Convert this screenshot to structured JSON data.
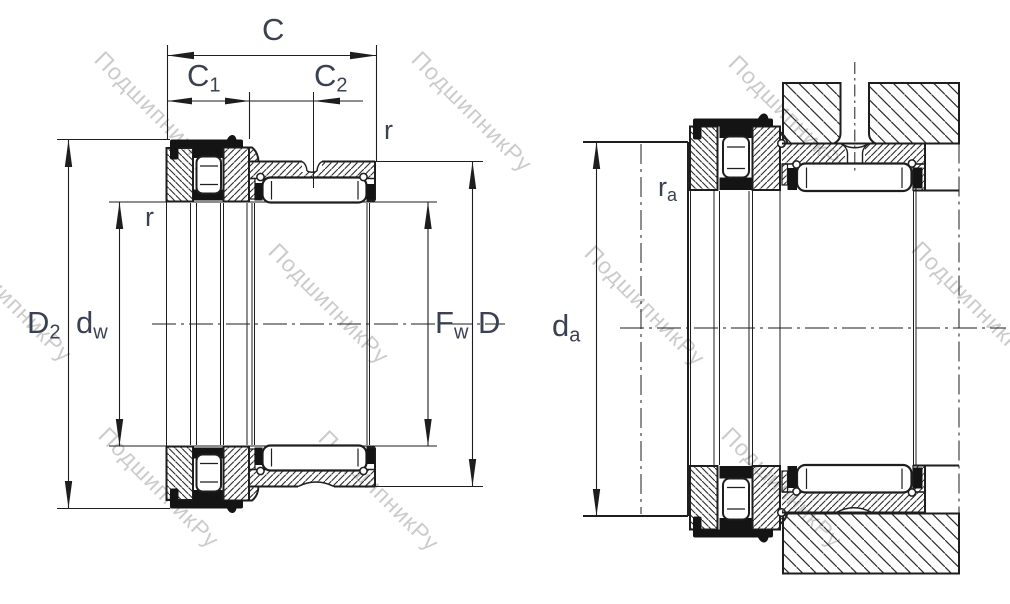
{
  "watermark": {
    "text": "ПодшипникРу",
    "color": "#c9c9c9"
  },
  "colors": {
    "line": "#1e1e1e",
    "label": "#3a4252",
    "background": "#ffffff"
  },
  "views": {
    "left": {
      "name": "bearing cross section",
      "labels": {
        "c": {
          "main": "C",
          "sub": ""
        },
        "c1": {
          "main": "C",
          "sub": "1"
        },
        "c2": {
          "main": "C",
          "sub": "2"
        },
        "r_top": {
          "main": "r",
          "sub": ""
        },
        "r_bore": {
          "main": "r",
          "sub": ""
        },
        "d2": {
          "main": "D",
          "sub": "2"
        },
        "dw": {
          "main": "d",
          "sub": "w"
        },
        "fw": {
          "main": "F",
          "sub": "w"
        },
        "d": {
          "main": "D",
          "sub": ""
        }
      }
    },
    "right": {
      "name": "mounting dimensions",
      "labels": {
        "ra": {
          "main": "r",
          "sub": "a"
        },
        "da": {
          "main": "d",
          "sub": "a"
        }
      }
    }
  }
}
